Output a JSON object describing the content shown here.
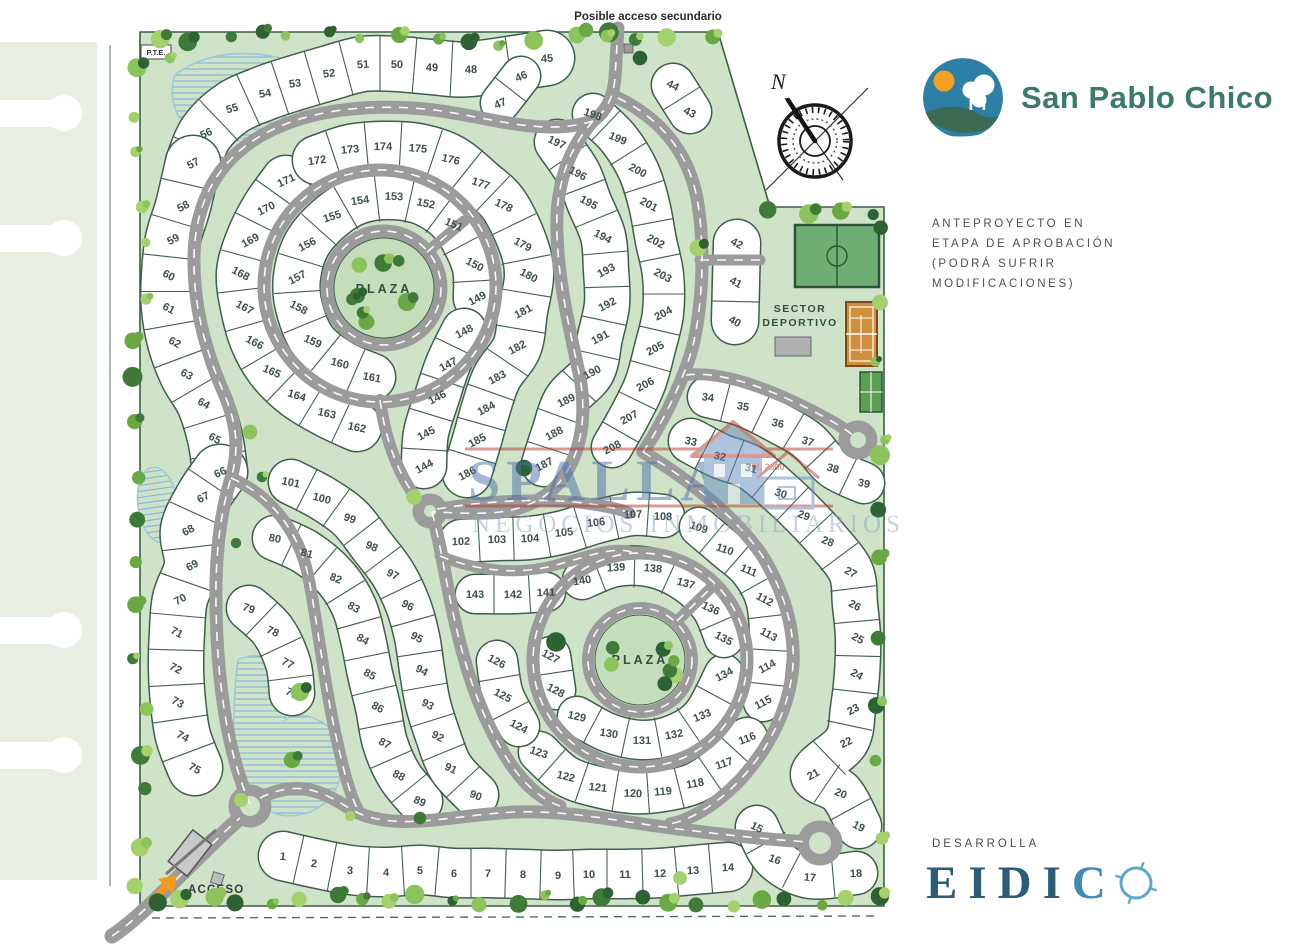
{
  "branding": {
    "project_name": "San Pablo Chico",
    "developer_label": "DESARROLLA",
    "developer_letters": [
      "E",
      "I",
      "D",
      "I",
      "C"
    ],
    "approval_note": "ANTEPROYECTO EN\nETAPA DE APROBACIÓN\n(PODRÁ SUFRIR\nMODIFICACIONES)"
  },
  "map_labels": {
    "secondary_access": "Posible acceso secundario",
    "pte": "P.T.E.",
    "plaza_upper": "PLAZA",
    "plaza_lower": "PLAZA",
    "sector_line1": "SECTOR",
    "sector_line2": "DEPORTIVO",
    "access": "ACCESO",
    "compass_north": "N"
  },
  "watermark": {
    "line1": "SPALLA",
    "line2": "NEGOCIOS INMOBILIARIOS",
    "badge": "M. 2600"
  },
  "colors": {
    "site_green": "#cfe3c9",
    "plaza_green": "#c4ddbb",
    "road_gray": "#9b9b9b",
    "lot_white": "#ffffff",
    "lot_line": "#3f5f4c",
    "lot_number": "#3d5049",
    "boundary": "#3a5f44",
    "brand_teal": "#3d7a6e",
    "logo_blue": "#2e7fa6",
    "sun_orange": "#f2a024",
    "access_orange": "#f49a1f",
    "eidico_blue": "#2c5c77",
    "eidico_light": "#5fa8cd",
    "watermark_blue": "#4c6fa8",
    "watermark_red": "#b23a2e",
    "field_green": "#6fae73",
    "court_orange": "#cf8f3e"
  },
  "lots": [
    [
      1,
      283,
      856
    ],
    [
      2,
      314,
      863
    ],
    [
      3,
      350,
      870
    ],
    [
      4,
      386,
      872
    ],
    [
      5,
      420,
      870
    ],
    [
      6,
      454,
      873
    ],
    [
      7,
      488,
      873
    ],
    [
      8,
      523,
      874
    ],
    [
      9,
      558,
      875
    ],
    [
      10,
      589,
      874
    ],
    [
      11,
      625,
      874
    ],
    [
      12,
      660,
      873
    ],
    [
      13,
      693,
      870
    ],
    [
      14,
      728,
      867
    ],
    [
      15,
      757,
      827
    ],
    [
      16,
      775,
      859
    ],
    [
      17,
      810,
      877
    ],
    [
      18,
      856,
      873
    ],
    [
      19,
      859,
      826
    ],
    [
      20,
      841,
      793
    ],
    [
      21,
      813,
      774
    ],
    [
      22,
      846,
      742
    ],
    [
      23,
      853,
      709
    ],
    [
      24,
      857,
      674
    ],
    [
      25,
      858,
      638
    ],
    [
      26,
      855,
      605
    ],
    [
      27,
      851,
      572
    ],
    [
      28,
      828,
      541
    ],
    [
      29,
      804,
      515
    ],
    [
      30,
      781,
      493
    ],
    [
      31,
      751,
      468
    ],
    [
      32,
      720,
      456
    ],
    [
      33,
      691,
      441
    ],
    [
      34,
      708,
      397
    ],
    [
      35,
      743,
      406
    ],
    [
      36,
      778,
      423
    ],
    [
      37,
      808,
      441
    ],
    [
      38,
      833,
      468
    ],
    [
      39,
      864,
      483
    ],
    [
      40,
      735,
      321
    ],
    [
      41,
      736,
      282
    ],
    [
      42,
      737,
      243
    ],
    [
      43,
      690,
      112
    ],
    [
      44,
      673,
      85
    ],
    [
      45,
      547,
      58
    ],
    [
      46,
      521,
      76
    ],
    [
      47,
      500,
      103
    ],
    [
      48,
      471,
      69
    ],
    [
      49,
      432,
      67
    ],
    [
      50,
      397,
      64
    ],
    [
      51,
      363,
      64
    ],
    [
      52,
      329,
      73
    ],
    [
      53,
      295,
      83
    ],
    [
      54,
      265,
      93
    ],
    [
      55,
      232,
      108
    ],
    [
      56,
      206,
      133
    ],
    [
      57,
      193,
      163
    ],
    [
      58,
      183,
      206
    ],
    [
      59,
      173,
      239
    ],
    [
      60,
      169,
      275
    ],
    [
      61,
      169,
      308
    ],
    [
      62,
      175,
      342
    ],
    [
      63,
      187,
      374
    ],
    [
      64,
      204,
      403
    ],
    [
      65,
      215,
      438
    ],
    [
      66,
      220,
      472
    ],
    [
      67,
      203,
      497
    ],
    [
      68,
      188,
      530
    ],
    [
      69,
      192,
      565
    ],
    [
      70,
      180,
      599
    ],
    [
      71,
      177,
      632
    ],
    [
      72,
      176,
      668
    ],
    [
      73,
      178,
      702
    ],
    [
      74,
      183,
      736
    ],
    [
      75,
      195,
      768
    ],
    [
      76,
      292,
      693
    ],
    [
      77,
      288,
      663
    ],
    [
      78,
      273,
      631
    ],
    [
      79,
      249,
      608
    ],
    [
      80,
      275,
      538
    ],
    [
      81,
      307,
      553
    ],
    [
      82,
      336,
      578
    ],
    [
      83,
      354,
      607
    ],
    [
      84,
      363,
      639
    ],
    [
      85,
      370,
      674
    ],
    [
      86,
      378,
      707
    ],
    [
      87,
      385,
      743
    ],
    [
      88,
      399,
      775
    ],
    [
      89,
      420,
      801
    ],
    [
      90,
      476,
      795
    ],
    [
      91,
      451,
      768
    ],
    [
      92,
      438,
      736
    ],
    [
      93,
      428,
      704
    ],
    [
      94,
      422,
      670
    ],
    [
      95,
      417,
      637
    ],
    [
      96,
      408,
      605
    ],
    [
      97,
      393,
      574
    ],
    [
      98,
      372,
      546
    ],
    [
      99,
      350,
      518
    ],
    [
      100,
      322,
      498
    ],
    [
      101,
      291,
      482
    ],
    [
      102,
      461,
      541
    ],
    [
      103,
      497,
      539
    ],
    [
      104,
      530,
      538
    ],
    [
      105,
      564,
      532
    ],
    [
      106,
      596,
      522
    ],
    [
      107,
      633,
      514
    ],
    [
      108,
      663,
      516
    ],
    [
      109,
      699,
      527
    ],
    [
      110,
      725,
      549
    ],
    [
      111,
      749,
      570
    ],
    [
      112,
      765,
      599
    ],
    [
      113,
      769,
      634
    ],
    [
      114,
      767,
      666
    ],
    [
      115,
      763,
      702
    ],
    [
      116,
      747,
      738
    ],
    [
      117,
      724,
      763
    ],
    [
      118,
      695,
      783
    ],
    [
      119,
      663,
      791
    ],
    [
      120,
      633,
      793
    ],
    [
      121,
      598,
      787
    ],
    [
      122,
      566,
      776
    ],
    [
      123,
      539,
      752
    ],
    [
      124,
      519,
      726
    ],
    [
      125,
      503,
      695
    ],
    [
      126,
      497,
      661
    ],
    [
      127,
      551,
      656
    ],
    [
      128,
      556,
      690
    ],
    [
      129,
      577,
      716
    ],
    [
      130,
      609,
      733
    ],
    [
      131,
      642,
      740
    ],
    [
      132,
      674,
      734
    ],
    [
      133,
      702,
      715
    ],
    [
      134,
      724,
      674
    ],
    [
      135,
      724,
      638
    ],
    [
      136,
      711,
      608
    ],
    [
      137,
      686,
      583
    ],
    [
      138,
      653,
      568
    ],
    [
      139,
      616,
      567
    ],
    [
      140,
      582,
      580
    ],
    [
      141,
      546,
      592
    ],
    [
      142,
      513,
      594
    ],
    [
      143,
      475,
      594
    ],
    [
      144,
      424,
      466
    ],
    [
      145,
      426,
      433
    ],
    [
      146,
      437,
      397
    ],
    [
      147,
      448,
      364
    ],
    [
      148,
      464,
      331
    ],
    [
      149,
      477,
      298
    ],
    [
      150,
      475,
      264
    ],
    [
      151,
      454,
      224
    ],
    [
      152,
      426,
      203
    ],
    [
      153,
      394,
      196
    ],
    [
      154,
      360,
      200
    ],
    [
      155,
      332,
      216
    ],
    [
      156,
      307,
      244
    ],
    [
      157,
      297,
      277
    ],
    [
      158,
      299,
      307
    ],
    [
      159,
      313,
      341
    ],
    [
      160,
      340,
      363
    ],
    [
      161,
      372,
      377
    ],
    [
      162,
      357,
      427
    ],
    [
      163,
      327,
      413
    ],
    [
      164,
      297,
      395
    ],
    [
      165,
      272,
      371
    ],
    [
      166,
      255,
      342
    ],
    [
      167,
      245,
      307
    ],
    [
      168,
      241,
      273
    ],
    [
      169,
      250,
      240
    ],
    [
      170,
      266,
      208
    ],
    [
      171,
      286,
      180
    ],
    [
      172,
      317,
      160
    ],
    [
      173,
      350,
      149
    ],
    [
      174,
      383,
      146
    ],
    [
      175,
      418,
      148
    ],
    [
      176,
      451,
      159
    ],
    [
      177,
      481,
      183
    ],
    [
      178,
      504,
      205
    ],
    [
      179,
      523,
      244
    ],
    [
      180,
      529,
      275
    ],
    [
      181,
      523,
      311
    ],
    [
      182,
      517,
      347
    ],
    [
      183,
      497,
      377
    ],
    [
      184,
      486,
      408
    ],
    [
      185,
      477,
      440
    ],
    [
      186,
      467,
      473
    ],
    [
      187,
      544,
      464
    ],
    [
      188,
      554,
      433
    ],
    [
      189,
      566,
      400
    ],
    [
      190,
      592,
      372
    ],
    [
      191,
      600,
      337
    ],
    [
      192,
      607,
      304
    ],
    [
      193,
      606,
      270
    ],
    [
      194,
      603,
      236
    ],
    [
      195,
      589,
      202
    ],
    [
      196,
      578,
      173
    ],
    [
      197,
      557,
      142
    ],
    [
      198,
      593,
      114
    ],
    [
      199,
      618,
      138
    ],
    [
      200,
      638,
      170
    ],
    [
      201,
      649,
      204
    ],
    [
      202,
      656,
      241
    ],
    [
      203,
      663,
      275
    ],
    [
      204,
      663,
      313
    ],
    [
      205,
      655,
      348
    ],
    [
      206,
      645,
      384
    ],
    [
      207,
      629,
      417
    ],
    [
      208,
      612,
      447
    ]
  ],
  "bands": [
    {
      "seq": [
        45,
        48,
        49,
        50,
        51,
        52,
        53,
        54,
        55,
        56,
        57
      ],
      "w": 54
    },
    {
      "seq": [
        46,
        47
      ],
      "w": 38
    },
    {
      "seq": [
        57,
        58,
        59,
        60,
        61,
        62,
        63,
        64,
        65,
        66
      ],
      "w": 54
    },
    {
      "seq": [
        66,
        67,
        68,
        69,
        70,
        71,
        72,
        73,
        74,
        75
      ],
      "w": 54
    },
    {
      "seq": [
        44,
        43
      ],
      "w": 42
    },
    {
      "seq": [
        42,
        41,
        40
      ],
      "w": 46
    },
    {
      "seq": [
        34,
        35,
        36,
        37,
        38,
        39
      ],
      "w": 40
    },
    {
      "seq": [
        33,
        32,
        31,
        30,
        29,
        28,
        27,
        26,
        25,
        24,
        23,
        22,
        21,
        20,
        19
      ],
      "w": 44
    },
    {
      "seq": [
        1,
        2,
        3,
        4,
        5,
        6,
        7,
        8,
        9,
        10,
        11,
        12,
        13,
        14
      ],
      "w": 48
    },
    {
      "seq": [
        15,
        16,
        17,
        18
      ],
      "w": 42
    },
    {
      "seq": [
        149,
        150,
        151,
        152,
        153,
        154,
        155,
        156,
        157,
        158,
        159,
        160,
        161
      ],
      "w": 46
    },
    {
      "seq": [
        171,
        170,
        169,
        168,
        167,
        166,
        165,
        164,
        163,
        162
      ],
      "w": 48
    },
    {
      "seq": [
        172,
        173,
        174,
        175,
        176,
        177,
        178,
        179,
        180,
        181,
        182,
        183,
        184,
        185,
        186
      ],
      "w": 48
    },
    {
      "seq": [
        144,
        145,
        146,
        147,
        148
      ],
      "w": 44
    },
    {
      "seq": [
        187,
        188,
        189,
        190,
        191,
        192,
        193,
        194,
        195,
        196,
        197
      ],
      "w": 44
    },
    {
      "seq": [
        198,
        199,
        200,
        201,
        202,
        203,
        204,
        205,
        206,
        207,
        208
      ],
      "w": 40
    },
    {
      "seq": [
        102,
        103,
        104,
        105,
        106,
        107,
        108
      ],
      "w": 42
    },
    {
      "seq": [
        109,
        110,
        111,
        112,
        113,
        114,
        115
      ],
      "w": 38
    },
    {
      "seq": [
        116,
        117,
        118,
        119,
        120,
        121,
        122,
        123
      ],
      "w": 40
    },
    {
      "seq": [
        124,
        125,
        126
      ],
      "w": 40
    },
    {
      "seq": [
        127,
        128
      ],
      "w": 38
    },
    {
      "seq": [
        129,
        130,
        131,
        132,
        133,
        134
      ],
      "w": 38
    },
    {
      "seq": [
        135,
        136,
        137,
        138,
        139,
        140
      ],
      "w": 38
    },
    {
      "seq": [
        141,
        142,
        143
      ],
      "w": 38
    },
    {
      "seq": [
        76,
        77,
        78,
        79
      ],
      "w": 44
    },
    {
      "seq": [
        80,
        81,
        82,
        83,
        84,
        85,
        86,
        87,
        88,
        89
      ],
      "w": 44
    },
    {
      "seq": [
        90,
        91,
        92,
        93,
        94,
        95,
        96,
        97,
        98,
        99,
        100,
        101
      ],
      "w": 44
    }
  ]
}
